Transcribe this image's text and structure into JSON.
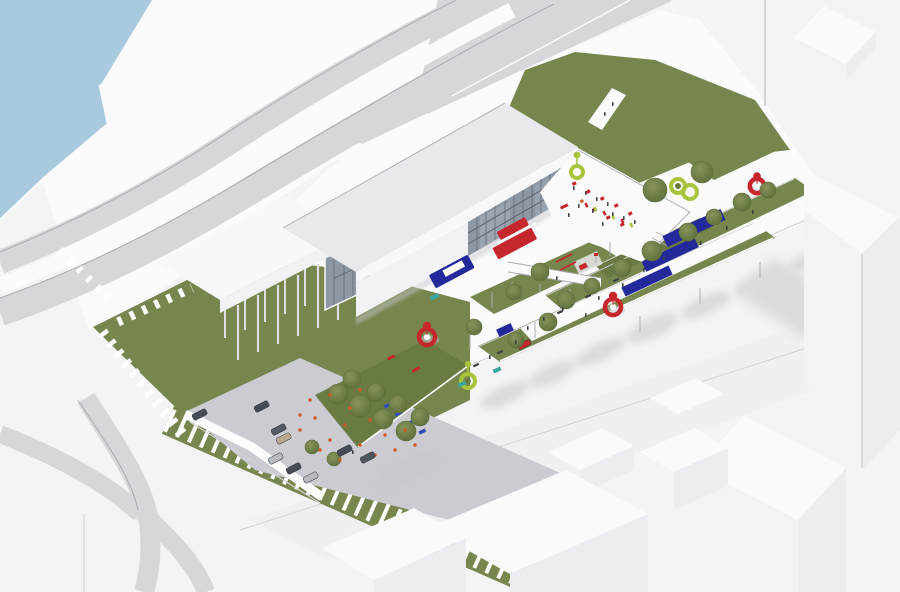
{
  "meta": {
    "title": "Aerial architectural rendering — riverside cultural campus masterplan",
    "canvas": {
      "width": 900,
      "height": 592
    },
    "view": "bird's-eye axonometric render, white massing context"
  },
  "scene": {
    "description": "White 3D massing render of a masterplan: a long low museum building with a glazed facade raised on pilotis sits on a white deck beside a highway interchange and river; a great lawn with amphitheater steps, a parking lot with cars, and a linear tree-lined promenade with blue exhibition walls, red kiosks and playgrounds extend to the southeast, surrounded by abstract white city blocks.",
    "elements": [
      "river-water",
      "highway-ramps",
      "top-road",
      "embankment-deck",
      "site-deck",
      "upper-lawn",
      "great-lawn",
      "amphitheater-steps",
      "stepped-slope",
      "parking-lot",
      "cars",
      "main-building",
      "curtain-wall-glass",
      "pilotis-wing",
      "entrance-glass",
      "event-terrace",
      "red-pavilion",
      "blue-info-counter",
      "footbridge",
      "linear-park-promenade",
      "grass-strips",
      "street-trees",
      "exhibition-wall-blue",
      "red-kiosk",
      "green-seating-ring",
      "playground",
      "benches",
      "light-poles",
      "lounge-chairs",
      "banners",
      "people",
      "lawn-visitors",
      "context-blocks",
      "tree-shadows"
    ]
  },
  "colors": {
    "bg": "#f4f4f6",
    "water": "#a9cade",
    "pavementBright": "#fbfbfd",
    "roadGray": "#d7d7db",
    "roadEdge": "#97979f",
    "laneLine": "#ffffff",
    "roadWash": "#ececf0",
    "edgeLight": "#d2d2d8",
    "lawn": "#77864d",
    "lawnDark": "#6a7a43",
    "treeHi": "#87935a",
    "treeLo": "#5d6e3b",
    "parking": "#cbcbd1",
    "roofGray": "#e9e9ed",
    "slabWhite": "#f8f8fa",
    "wallWhite": "#f2f2f5",
    "facadeGlass": "#8e98a5",
    "glassMullion": "#525c68",
    "pillar": "#dcdce2",
    "pillarLight": "#e9e9ee",
    "railGray": "#aaaab2",
    "accentRed": "#c5272d",
    "accentBlue": "#23299b",
    "accentLime": "#a8c43c",
    "accentOrange": "#cf5a26",
    "accentTeal": "#3aa6a0",
    "figureDark": "#3c4147",
    "carDark": "#474c54",
    "carSilver": "#b7babf",
    "carTan": "#b8a98f",
    "shadowSoft": "#c6c6cc",
    "contextTop": "#fafafb",
    "contextSide": "#ededf1",
    "contextSideLight": "#f3f3f5"
  }
}
